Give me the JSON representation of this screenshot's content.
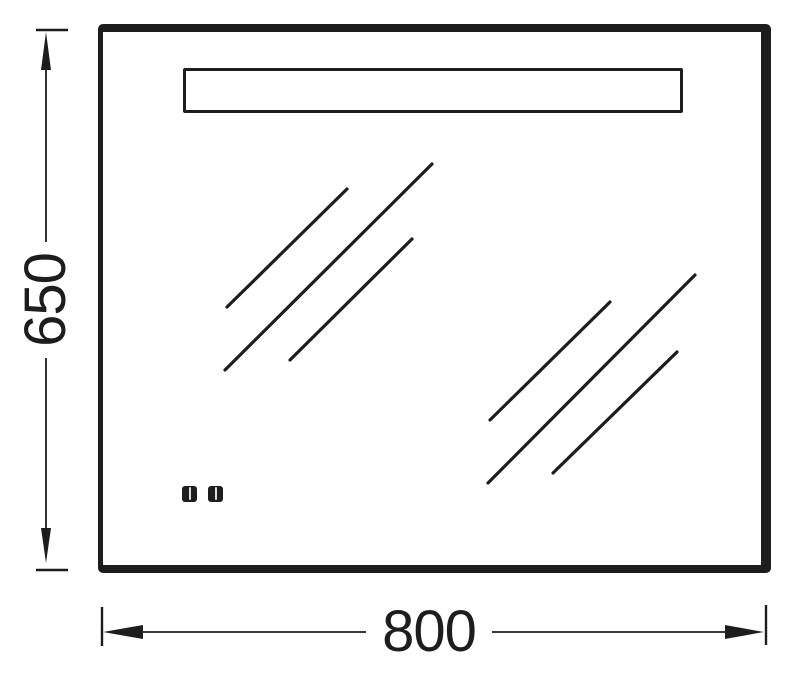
{
  "dimensions": {
    "height": {
      "value": "650"
    },
    "width": {
      "value": "800"
    }
  },
  "colors": {
    "line": "#1d1d1d",
    "background": "#ffffff"
  }
}
